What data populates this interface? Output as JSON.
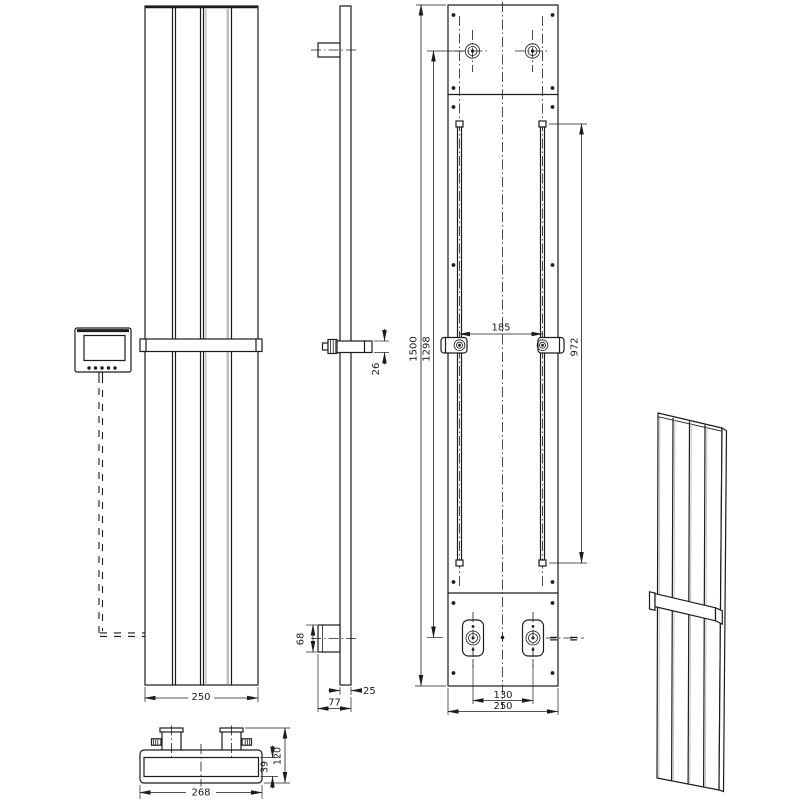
{
  "drawing": {
    "type": "radiator-technical-drawing",
    "description": "Orthographic and isometric views of a vertical panel radiator with towel bar, wall rails, controller and connection valves"
  },
  "dims": {
    "front_width": "250",
    "towel_bar_profile_height": "26",
    "bottom_bracket_height": "68",
    "profile_depth": "25",
    "total_side_depth": "77",
    "overall_height": "1500",
    "connection_span_vertical": "1298",
    "rail_length": "972",
    "rail_spacing": "185",
    "valve_spacing": "130",
    "back_width": "250",
    "towel_bar_width": "268",
    "top_total_depth": "120",
    "body_depth": "39"
  },
  "symbols": {
    "equal_left": "=",
    "equal_right": "="
  },
  "colors": {
    "line": "#1c1c1c",
    "shade_gray": "#c0c0c0",
    "background": "#ffffff"
  }
}
